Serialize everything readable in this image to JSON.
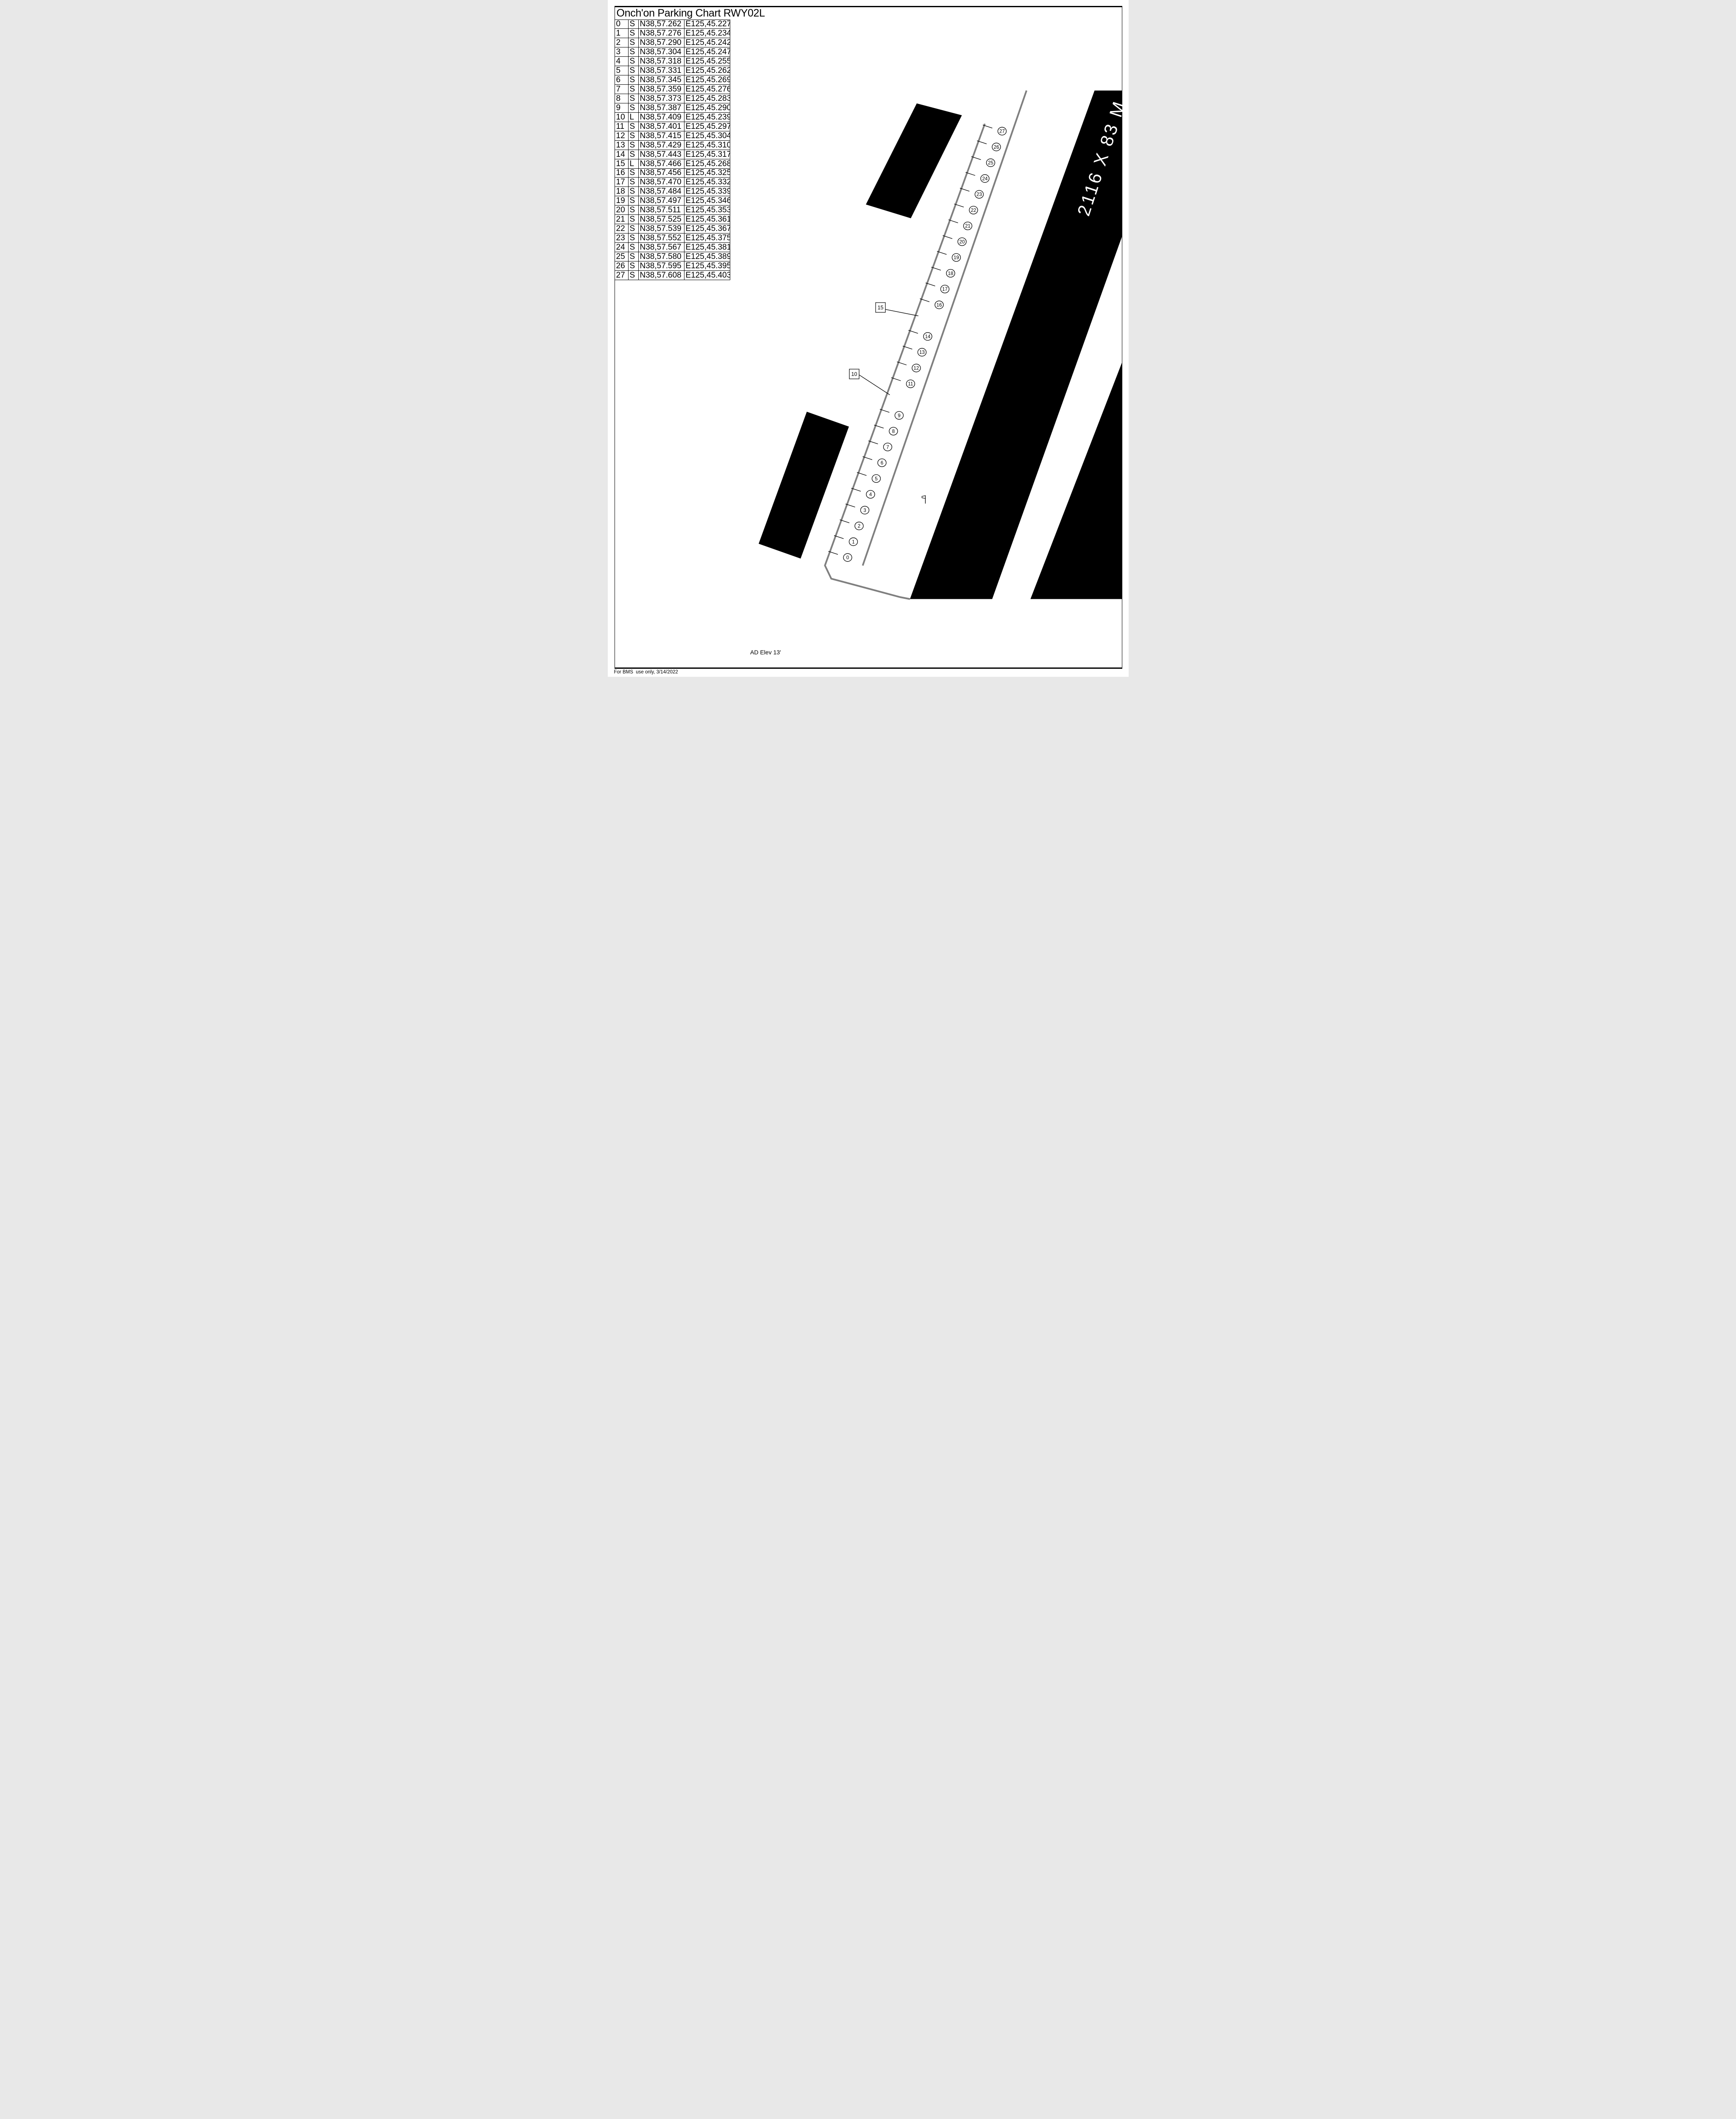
{
  "title": "Onch'on Parking Chart RWY02L",
  "footer": "For BMS  use only, 3/14/2022",
  "ad_elevation": "AD Elev 13'",
  "runway": {
    "dimension_label": "2116 X 83 M"
  },
  "colors": {
    "ink": "#000000",
    "paper": "#ffffff",
    "taxiway_gray": "#7f7f7f"
  },
  "table": {
    "columns": [
      "spot",
      "type",
      "latitude",
      "longitude"
    ],
    "rows": [
      {
        "id": "0",
        "type": "S",
        "lat": "N38,57.262",
        "lon": "E125,45.227"
      },
      {
        "id": "1",
        "type": "S",
        "lat": "N38,57.276",
        "lon": "E125,45.234"
      },
      {
        "id": "2",
        "type": "S",
        "lat": "N38,57.290",
        "lon": "E125,45.242"
      },
      {
        "id": "3",
        "type": "S",
        "lat": "N38,57.304",
        "lon": "E125,45.247"
      },
      {
        "id": "4",
        "type": "S",
        "lat": "N38,57.318",
        "lon": "E125,45.255"
      },
      {
        "id": "5",
        "type": "S",
        "lat": "N38,57.331",
        "lon": "E125,45.262"
      },
      {
        "id": "6",
        "type": "S",
        "lat": "N38,57.345",
        "lon": "E125,45.269"
      },
      {
        "id": "7",
        "type": "S",
        "lat": "N38,57.359",
        "lon": "E125,45.276"
      },
      {
        "id": "8",
        "type": "S",
        "lat": "N38,57.373",
        "lon": "E125,45.283"
      },
      {
        "id": "9",
        "type": "S",
        "lat": "N38,57.387",
        "lon": "E125,45.290"
      },
      {
        "id": "10",
        "type": "L",
        "lat": "N38,57.409",
        "lon": "E125,45.239"
      },
      {
        "id": "11",
        "type": "S",
        "lat": "N38,57.401",
        "lon": "E125,45.297"
      },
      {
        "id": "12",
        "type": "S",
        "lat": "N38,57.415",
        "lon": "E125,45.304"
      },
      {
        "id": "13",
        "type": "S",
        "lat": "N38,57.429",
        "lon": "E125,45.310"
      },
      {
        "id": "14",
        "type": "S",
        "lat": "N38,57.443",
        "lon": "E125,45.317"
      },
      {
        "id": "15",
        "type": "L",
        "lat": "N38,57.466",
        "lon": "E125,45.268"
      },
      {
        "id": "16",
        "type": "S",
        "lat": "N38,57.456",
        "lon": "E125,45.325"
      },
      {
        "id": "17",
        "type": "S",
        "lat": "N38,57.470",
        "lon": "E125,45.332"
      },
      {
        "id": "18",
        "type": "S",
        "lat": "N38,57.484",
        "lon": "E125,45.339"
      },
      {
        "id": "19",
        "type": "S",
        "lat": "N38,57.497",
        "lon": "E125,45.346"
      },
      {
        "id": "20",
        "type": "S",
        "lat": "N38,57.511",
        "lon": "E125,45.353"
      },
      {
        "id": "21",
        "type": "S",
        "lat": "N38,57.525",
        "lon": "E125,45.361"
      },
      {
        "id": "22",
        "type": "S",
        "lat": "N38,57.539",
        "lon": "E125,45.367"
      },
      {
        "id": "23",
        "type": "S",
        "lat": "N38,57.552",
        "lon": "E125,45.375"
      },
      {
        "id": "24",
        "type": "S",
        "lat": "N38,57.567",
        "lon": "E125,45.381"
      },
      {
        "id": "25",
        "type": "S",
        "lat": "N38,57.580",
        "lon": "E125,45.389"
      },
      {
        "id": "26",
        "type": "S",
        "lat": "N38,57.595",
        "lon": "E125,45.395"
      },
      {
        "id": "27",
        "type": "S",
        "lat": "N38,57.608",
        "lon": "E125,45.403"
      }
    ]
  }
}
